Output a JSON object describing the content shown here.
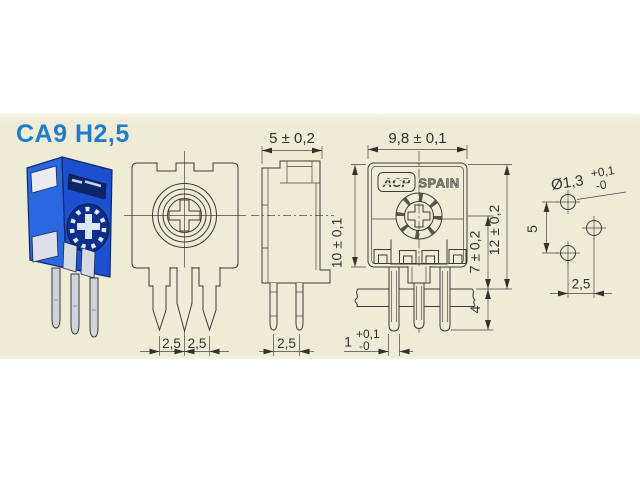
{
  "page": {
    "title": "CA9 H2,5"
  },
  "colors": {
    "panel_background": "#eeebd7",
    "drawing_line": "#3c3c34",
    "title_blue": "#1e7ecc",
    "trimmer_body_blue": "#2a67e0",
    "trimmer_dark_blue": "#0c2566",
    "pin_silver": "#cfd3da"
  },
  "front_view": {
    "pitch_left": "2,5",
    "pitch_right": "2,5"
  },
  "side_view": {
    "body_depth": "5 ± 0,2",
    "pin_pitch": "2,5"
  },
  "main_view": {
    "body_width": "9,8 ± 0,1",
    "body_height": "10 ± 0,1",
    "center_height": "7 ± 0,2",
    "total_height": "12 ± 0,2",
    "pin_protrusion": "4",
    "pin_thickness": "1",
    "pin_thickness_tol_plus": "+0,1",
    "pin_thickness_tol_minus": "-0",
    "logo": "ACP",
    "logo_country": "SPAIN"
  },
  "hole_layout": {
    "hole_diameter": "Ø1,3",
    "hole_tol_plus": "+0,1",
    "hole_tol_minus": "-0",
    "vertical_spacing": "5",
    "horizontal_spacing": "2,5"
  }
}
